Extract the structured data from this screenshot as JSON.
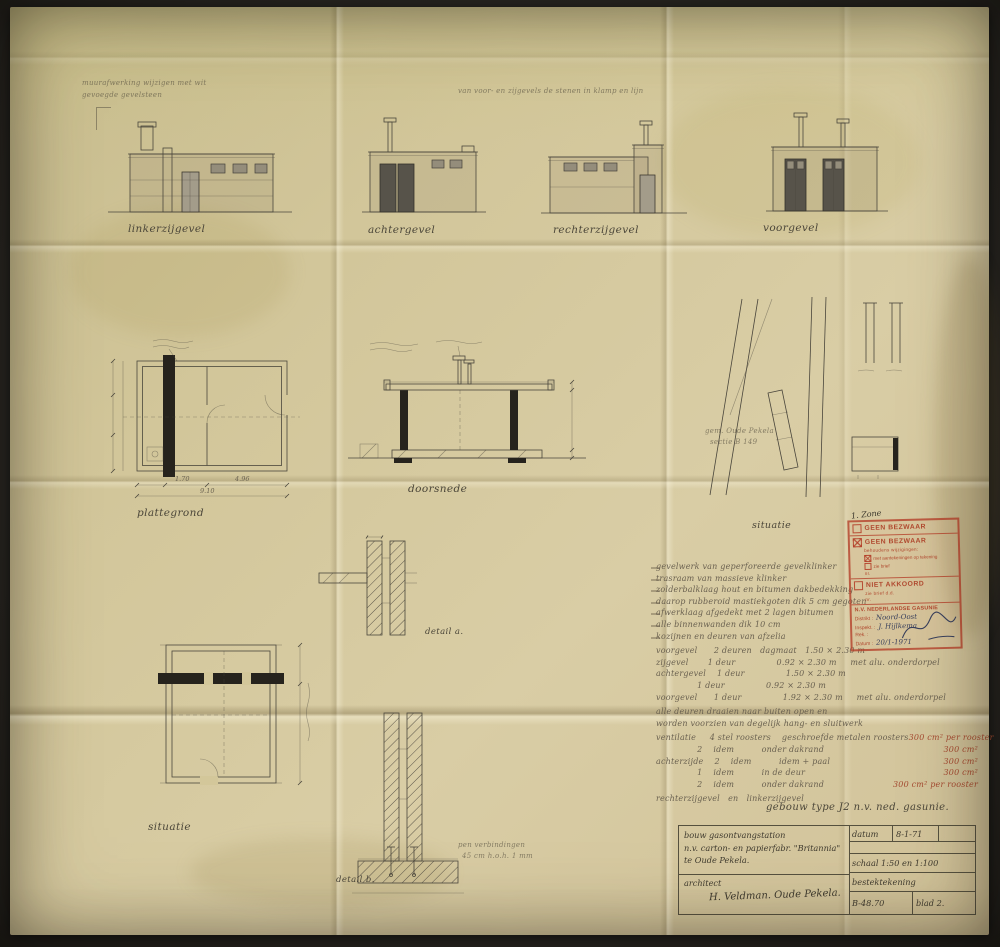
{
  "colors": {
    "photo_background": "#2b2925",
    "paper": "#d2c69a",
    "ink": "#4a463c",
    "stamp_red": "#b0492f",
    "pen_blue": "#39405c"
  },
  "annotations": {
    "top_left_1": "muurafwerking wijzigen met wit",
    "top_left_2": "gevoegde gevelsteen",
    "top_center": "van voor- en zijgevels de stenen in klamp en lijn"
  },
  "elevations": {
    "label_1": "linkerzijgevel",
    "label_2": "achtergevel",
    "label_3": "rechterzijgevel",
    "label_4": "voorgevel"
  },
  "drawings": {
    "plattegrond_label": "plattegrond",
    "doorsnede_label": "doorsnede",
    "situatie_mid_label": "situatie",
    "situatie_bottom_label": "situatie",
    "detail_a_label": "detail a.",
    "detail_b_label": "detail b.",
    "site_note_1": "gem. Oude Pekela",
    "site_note_2": "sectie B 149",
    "detail_b_note_1": "pen verbindingen",
    "detail_b_note_2": "45 cm h.o.h. 1 mm",
    "dim_seg_1": "1.70",
    "dim_seg_2": "4.96",
    "dim_total": "9.10"
  },
  "notes": {
    "spec_lines": [
      "gevelwerk van geperforeerde gevelklinker",
      "trasraam van massieve klinker",
      "zolderbalklaag hout en bitumen dakbedekking",
      "daarop rubberoid mastiekgoten dik 5 cm gegoten",
      "afwerklaag afgedekt met 2 lagen bitumen",
      "alle binnenwanden dik 10 cm",
      "kozijnen en deuren van afzelia"
    ],
    "door_lines": [
      "voorgevel      2 deuren   dagmaat   1.50 × 2.30 m",
      "zijgevel       1 deur               0.92 × 2.30 m     met alu. onderdorpel",
      "achtergevel    1 deur               1.50 × 2.30 m",
      "               1 deur               0.92 × 2.30 m",
      "voorgevel      1 deur               1.92 × 2.30 m     met alu. onderdorpel"
    ],
    "door_extra": [
      "alle deuren draaien naar buiten open en",
      "worden voorzien van degelijk hang- en sluitwerk"
    ],
    "vents": [
      {
        "text": "ventilatie     4 stel roosters    geschroefde metalen roosters",
        "red": "300 cm² per rooster"
      },
      {
        "text": "               2    idem          onder dakrand",
        "red": "300 cm²"
      },
      {
        "text": "achterzijde    2    idem          idem + paal",
        "red": "300 cm²"
      },
      {
        "text": "               1    idem          in de deur",
        "red": "300 cm²"
      },
      {
        "text": "               2    idem          onder dakrand",
        "red": "300 cm² per rooster"
      }
    ],
    "gevel_line": "rechterzijgevel   en   linkerzijgevel",
    "building_type": "gebouw type J2  n.v. ned. gasunie."
  },
  "stamp": {
    "handnote": "1. Zone",
    "row1": "GEEN BEZWAAR",
    "row2": "GEEN BEZWAAR",
    "row2_sub": "behoudens wijzigingen:",
    "row2_opt1": "met aantekeningen op tekening",
    "row2_opt2": "zie brief",
    "row2_nr": "nr.",
    "row3": "NIET AKKOORD",
    "row3_sub": "zie brief d.d.",
    "row3_nr": "nr.",
    "company": "N.V. NEDERLANDSE GASUNIE",
    "f1_label": "Distrikt :",
    "f1_value": "Noord-Oost",
    "f2_label": "Inspekt. :",
    "f2_value": "J. Hijlkema",
    "f3_label": "Rek. :",
    "f3_value": "",
    "f4_label": "Datum :",
    "f4_value": "20/1-1971"
  },
  "titleblock": {
    "project_1": "bouw gasontvangstation",
    "project_2": "n.v. carton- en papierfabr. \"Britannia\"",
    "project_3": "te Oude Pekela.",
    "architect_label": "architect",
    "architect_name": "H. Veldman. Oude Pekela.",
    "datum_label": "datum",
    "datum_value": "8-1-71",
    "schaal": "schaal 1:50 en 1:100",
    "doc_type": "bestektekening",
    "number": "B-48.70",
    "sheet": "blad 2."
  }
}
